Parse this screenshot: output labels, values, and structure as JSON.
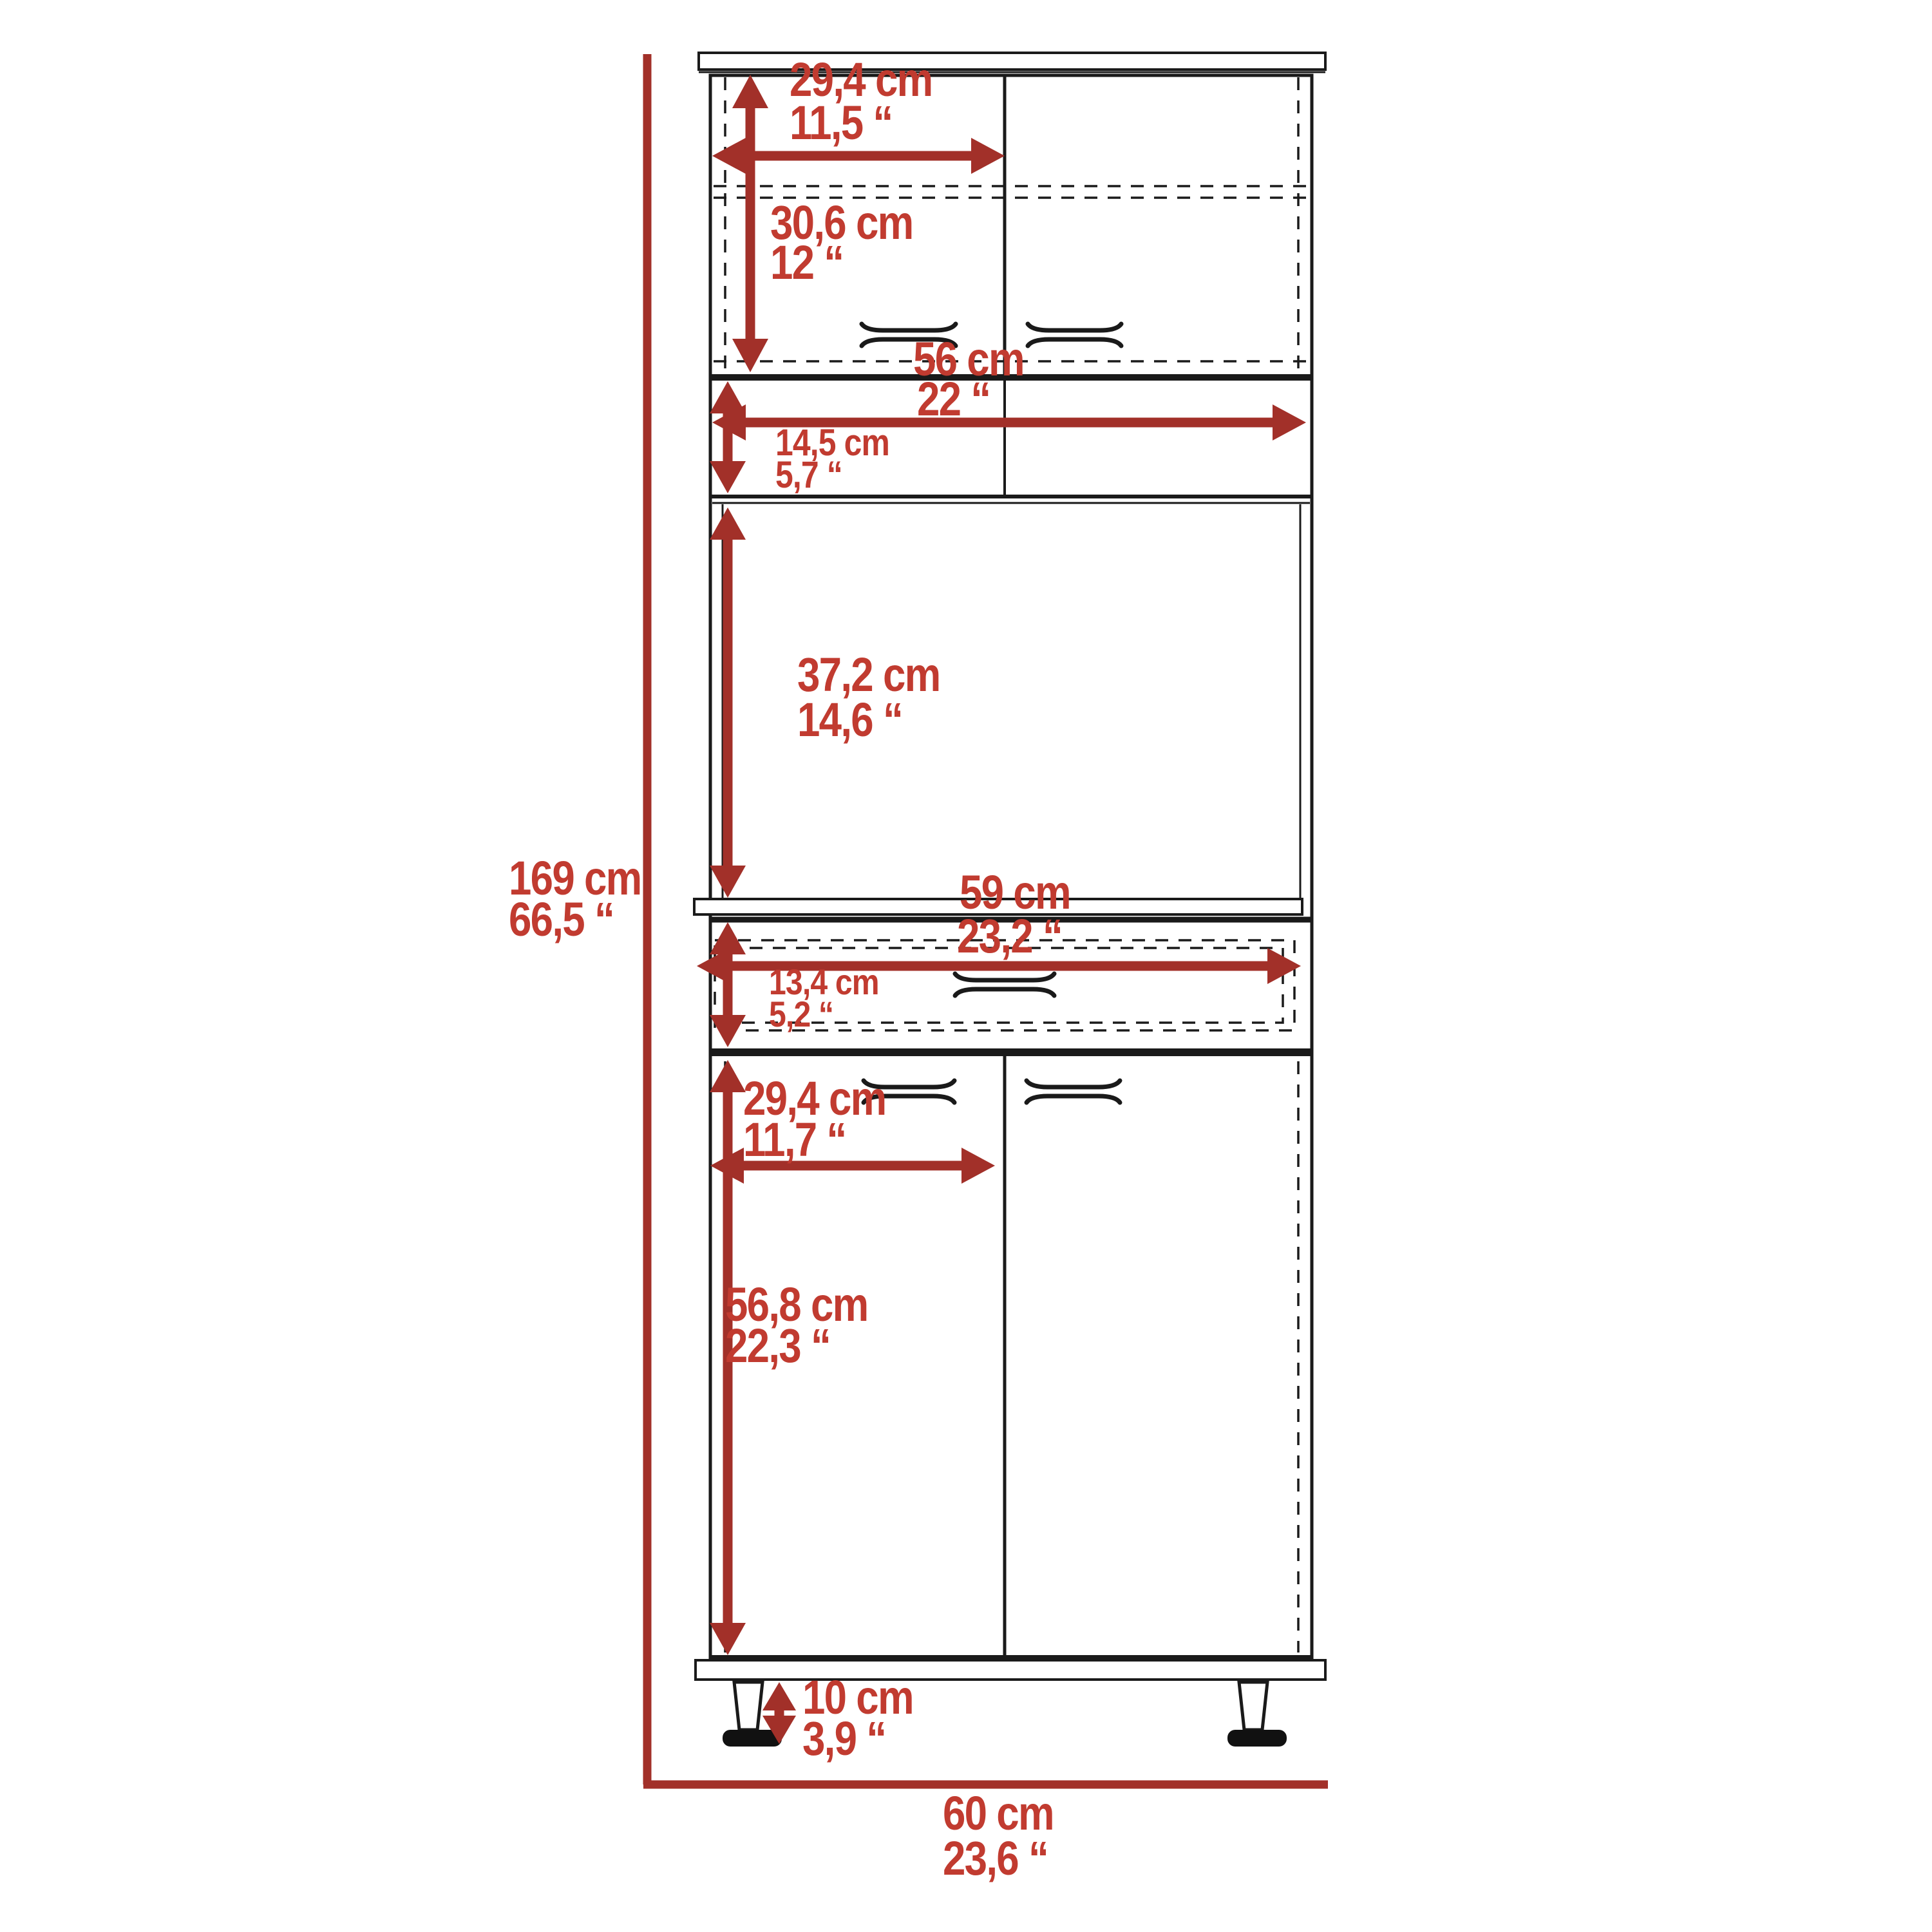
{
  "colors": {
    "dim-text": "#c13b30",
    "dim-line": "#a23029",
    "structure": "#1a1a1a",
    "background": "#ffffff"
  },
  "dimensions": {
    "upper_door_width": {
      "cm": "29,4 cm",
      "in": "11,5 “"
    },
    "upper_cabinet_height": {
      "cm": "30,6 cm",
      "in": "12 “"
    },
    "interior_width": {
      "cm": "56 cm",
      "in": "22 “"
    },
    "open_shelf_height": {
      "cm": "14,5 cm",
      "in": "5,7 “"
    },
    "microwave_space_height": {
      "cm": "37,2 cm",
      "in": "14,6 “"
    },
    "total_height": {
      "cm": "169 cm",
      "in": "66,5 “"
    },
    "drawer_width": {
      "cm": "59 cm",
      "in": "23,2 “"
    },
    "drawer_height": {
      "cm": "13,4 cm",
      "in": "5,2 “"
    },
    "lower_door_width": {
      "cm": "29,4 cm",
      "in": "11,7 “"
    },
    "lower_door_height": {
      "cm": "56,8 cm",
      "in": "22,3 “"
    },
    "leg_height": {
      "cm": "10 cm",
      "in": "3,9 “"
    },
    "total_width": {
      "cm": "60 cm",
      "in": "23,6 “"
    }
  }
}
